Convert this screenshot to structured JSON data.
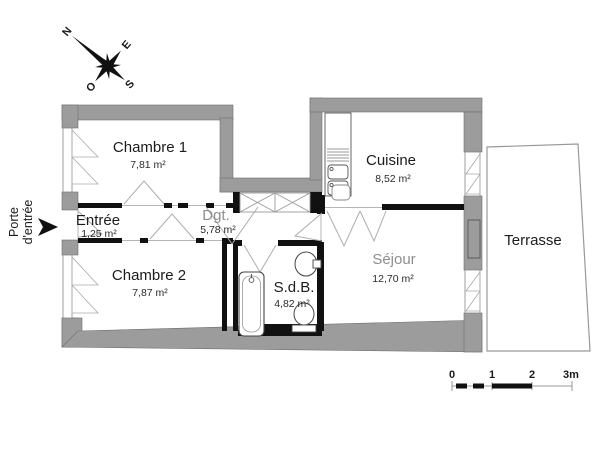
{
  "plan": {
    "title_hint": "apartment floor plan",
    "compass": {
      "n": "N",
      "e": "E",
      "s": "S",
      "o": "O"
    },
    "entry": {
      "line1": "Porte",
      "line2": "d'entrée"
    },
    "rooms": {
      "chambre1": {
        "name": "Chambre 1",
        "area": "7,81 m²"
      },
      "entree": {
        "name": "Entrée",
        "area": "1,25 m²"
      },
      "chambre2": {
        "name": "Chambre 2",
        "area": "7,87 m²"
      },
      "dgt": {
        "name": "Dgt.",
        "area": "5,78 m²"
      },
      "cuisine": {
        "name": "Cuisine",
        "area": "8,52 m²"
      },
      "sejour": {
        "name": "Séjour",
        "area": "12,70 m²"
      },
      "sdb": {
        "name": "S.d.B.",
        "area": "4,82 m²"
      },
      "terrasse": {
        "name": "Terrasse"
      }
    },
    "scale_bar": {
      "t0": "0",
      "t1": "1",
      "t2": "2",
      "t3": "3m"
    },
    "colors": {
      "wall_exterior": "#9c9c9c",
      "wall_interior": "#111111",
      "thin_line": "#b0b0b0",
      "grey_label": "#8e8e8e",
      "background": "#ffffff"
    }
  }
}
